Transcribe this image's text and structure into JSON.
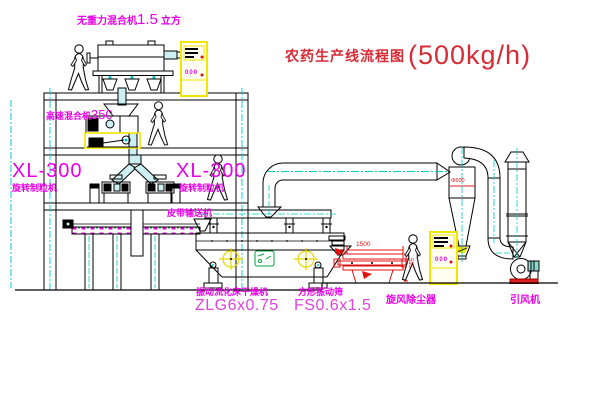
{
  "title": {
    "text": "农药生产线流程图",
    "capacity": "(500kg/h)"
  },
  "equipment": {
    "gravity_mixer": {
      "label_name": "无重力混合机",
      "label_size": "1.5",
      "label_unit": "立方"
    },
    "high_speed_mixer": {
      "label_name": "高速混合机",
      "label_size": "350"
    },
    "granulator_left": {
      "model": "XL-300",
      "name": "旋转制粒机"
    },
    "granulator_right": {
      "model": "XL-300",
      "name": "旋转制粒机"
    },
    "belt_conveyor": {
      "name": "皮带输送机"
    },
    "fluid_bed_dryer": {
      "name": "振动流化床干燥机",
      "model": "ZLG6x0.75"
    },
    "vibrating_sieve": {
      "name": "方形振动筛",
      "model": "FS0.6x1.5",
      "dim_width": "1500",
      "dim_height": "595"
    },
    "cyclone": {
      "name": "旋风除尘器",
      "dim": "Φ500"
    },
    "induced_draft_fan": {
      "name": "引风机"
    },
    "control_cabinet_1": {
      "indicator": "000"
    },
    "control_cabinet_2": {
      "indicator": "000"
    }
  },
  "colors": {
    "title_red": "#c22e3e",
    "label_magenta": "#e800e8",
    "model_magenta": "#dd44dd",
    "line_black": "#000000",
    "pipe_cyan": "#00cccc",
    "pipe_fill": "#cdeff2",
    "cabinet_yellow": "#f2e500",
    "sieve_red": "#e01010",
    "stamp_green": "#00a040",
    "fan_base_red": "#e02020"
  }
}
